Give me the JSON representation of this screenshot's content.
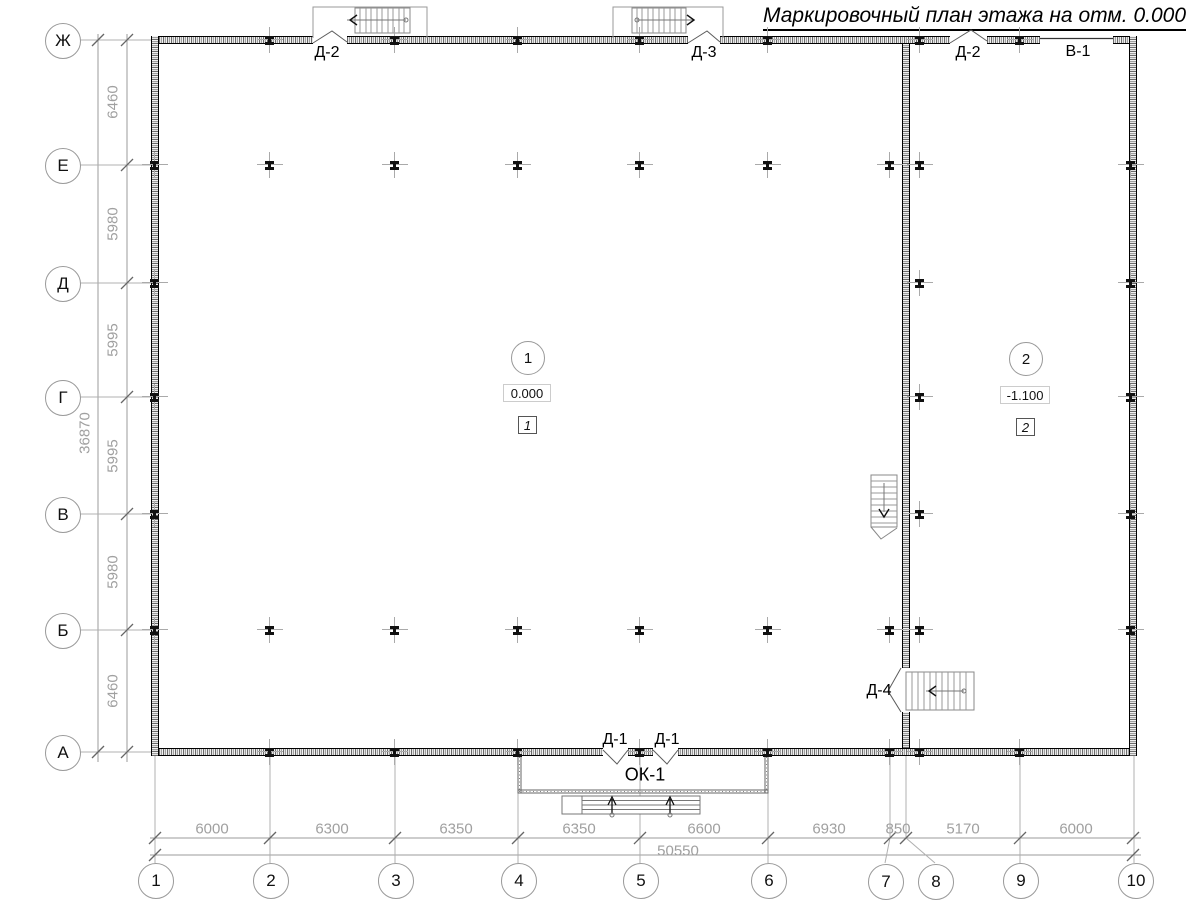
{
  "title": "Маркировочный план этажа на отм. 0.000",
  "axes": {
    "rows": [
      {
        "label": "Ж"
      },
      {
        "label": "Е"
      },
      {
        "label": "Д"
      },
      {
        "label": "Г"
      },
      {
        "label": "В"
      },
      {
        "label": "Б"
      },
      {
        "label": "А"
      }
    ],
    "cols": [
      {
        "label": "1"
      },
      {
        "label": "2"
      },
      {
        "label": "3"
      },
      {
        "label": "4"
      },
      {
        "label": "5"
      },
      {
        "label": "6"
      },
      {
        "label": "7"
      },
      {
        "label": "8"
      },
      {
        "label": "9"
      },
      {
        "label": "10"
      }
    ]
  },
  "dimensions": {
    "left": {
      "segments": [
        "6460",
        "5980",
        "5995",
        "5995",
        "5980",
        "6460"
      ],
      "total": "36870"
    },
    "bottom": {
      "segments": [
        "6000",
        "6300",
        "6350",
        "6350",
        "6600",
        "6930",
        "850",
        "5170",
        "6000"
      ],
      "total": "50550"
    }
  },
  "openings": {
    "top": [
      {
        "label": "Д-2"
      },
      {
        "label": "Д-3"
      },
      {
        "label": "Д-2"
      },
      {
        "label": "В-1"
      }
    ],
    "bottom_doors": [
      {
        "label": "Д-1"
      },
      {
        "label": "Д-1"
      }
    ],
    "porch": {
      "label": "ОК-1"
    },
    "interior_door": {
      "label": "Д-4"
    }
  },
  "rooms": [
    {
      "number": "1",
      "elevation": "0.000",
      "type_mark": "1"
    },
    {
      "number": "2",
      "elevation": "-1.100",
      "type_mark": "2"
    }
  ]
}
